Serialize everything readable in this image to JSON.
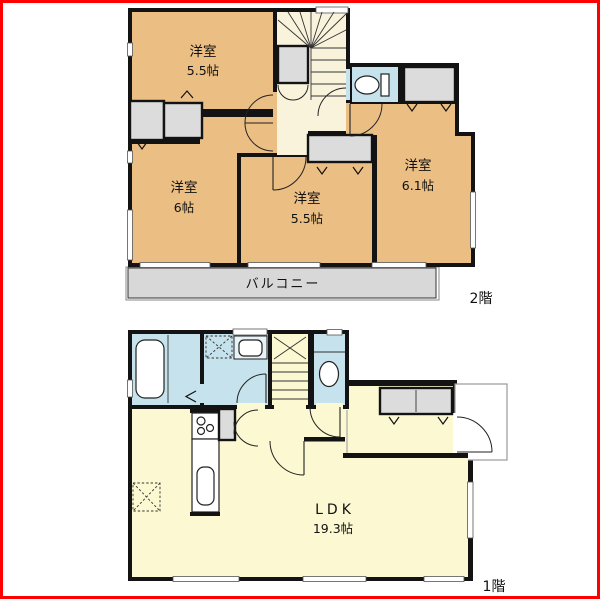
{
  "floor2": {
    "floor_label": "2階",
    "rooms": {
      "top_left": {
        "name": "洋室",
        "size": "5.5帖"
      },
      "bottom_left": {
        "name": "洋室",
        "size": "6帖"
      },
      "middle": {
        "name": "洋室",
        "size": "5.5帖"
      },
      "right": {
        "name": "洋室",
        "size": "6.1帖"
      }
    },
    "balcony": "バルコニー"
  },
  "floor1": {
    "floor_label": "1階",
    "ldk_name": "LDK",
    "ldk_size": "19.3帖"
  },
  "icons": {
    "toilet-icon": "bowl-ellipse-with-tank",
    "bathtub-icon": "rounded-rect-tub",
    "sink-icon": "rounded-basin",
    "stove-icon": "three-burner-circles",
    "washer-pan-icon": "dashed-square-x",
    "stairs-fan-icon": "radiating-winder-steps",
    "stairs-straight-icon": "parallel-treads",
    "door-arc-icon": "quarter-circle-swing",
    "folding-door-icon": "v-chevron-marks"
  },
  "colors": {
    "wall": "#131313",
    "room_tan": "#EBBE84",
    "hall_cream": "#FAF3DC",
    "ldk_yellow": "#FBF8D2",
    "water_blue": "#C6E2EC",
    "closet_gray": "#DCDCDC",
    "balcony_gray": "#D8D8D8",
    "frame_red": "#FF0000"
  }
}
